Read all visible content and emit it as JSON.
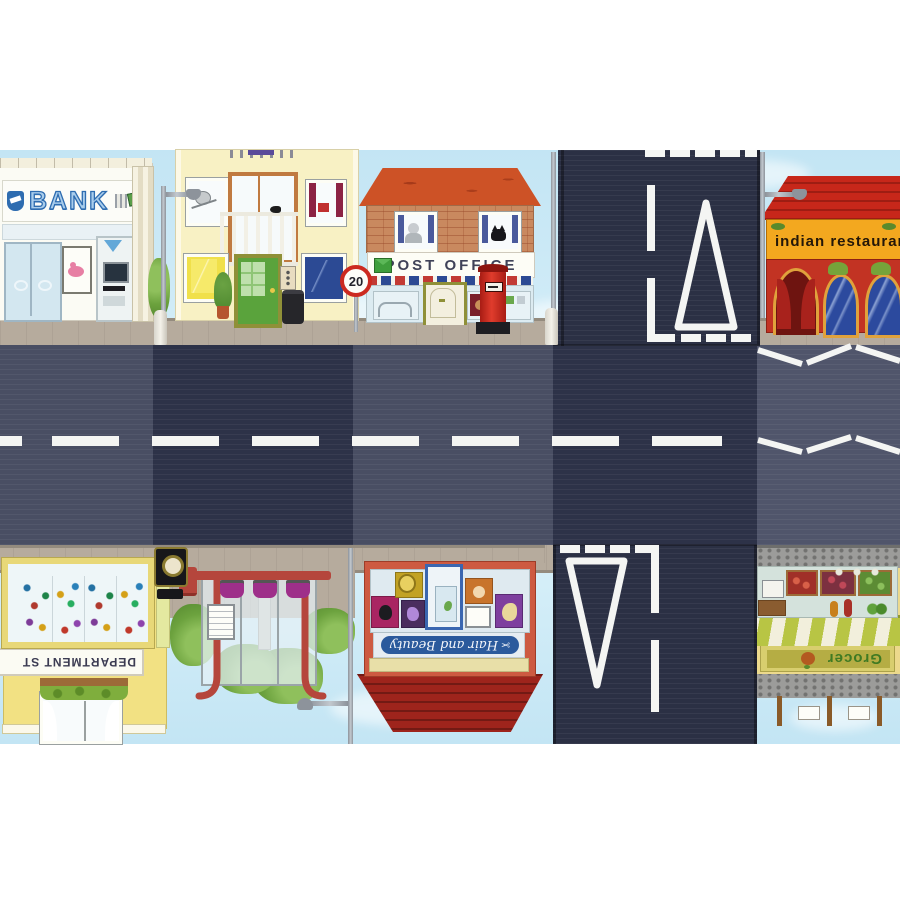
{
  "scene": {
    "title": "Toy town road play mat",
    "rows": [
      "shops street top",
      "two-lane road with T-junctions",
      "shops street bottom (printed upside-down)"
    ]
  },
  "signs": {
    "bank": "BANK",
    "post_office": "POST OFFICE",
    "speed_limit": "20",
    "indian_restaurant": "indian restaurant",
    "department_store": "DEPARTMENT ST",
    "hair_and_beauty": "Hair and Beauty",
    "grocer": "Grocer"
  },
  "icons": {
    "scissors": "✂",
    "bank_shield": "shield-logo",
    "atm_arrow": "arrow-down",
    "envelope": "envelope",
    "apple": "apple"
  },
  "road": {
    "markings": [
      "dashed centre line",
      "give-way triangle",
      "give-way broken lines",
      "zigzag crossing approach"
    ],
    "colors": {
      "surface_dark": "#2d3248",
      "surface_medium": "#494e63",
      "marking_white": "#f4f5f3"
    }
  },
  "palette": {
    "sky": "#c8e8f5",
    "pavement": "#b6ab9d",
    "post_office_roof": "#cd5226",
    "restaurant_red": "#c23323",
    "restaurant_sign_yellow": "#f3a81f",
    "grocer_awning_green": "#b8c544",
    "hair_beauty_sign_blue": "#2b5a9c",
    "bank_blue": "#2f6db5",
    "house_yellow": "#f8f1c4",
    "department_store_yellow": "#f2e183",
    "postbox_red": "#d3281c",
    "bus_shelter_red": "#b5463c",
    "seat_magenta": "#9e2f8a"
  }
}
